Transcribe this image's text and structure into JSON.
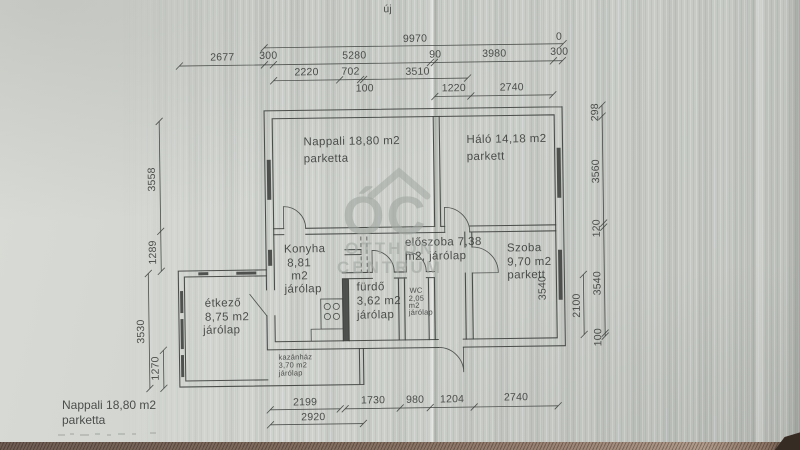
{
  "photo": {
    "top_annotation": "új"
  },
  "colors": {
    "paper": "#cdd0cb",
    "ink": "#3c3f3c",
    "watermark": "#a3a8a3",
    "fabric": "#7b675a"
  },
  "watermark": {
    "initials": "ÓC",
    "line1": "OTTHON",
    "line2": "CENTRUM"
  },
  "rooms": {
    "nappali": {
      "line1": "Nappali 18,80 m2",
      "line2": "parketta"
    },
    "halo": {
      "line1": "Háló 14,18 m2",
      "line2": "parkett"
    },
    "konyha": {
      "line1": "Konyha",
      "line2": "8,81",
      "line3": "m2",
      "line4": "járólap"
    },
    "etkezo": {
      "line1": "étkező",
      "line2": "8,75 m2",
      "line3": "járólap"
    },
    "eloszoba": {
      "line1": "előszoba 7,38",
      "line2": "m2, járólap"
    },
    "szoba": {
      "line1": "Szoba",
      "line2": "9,70 m2",
      "line3": "parkett",
      "inner_dim": "3540"
    },
    "furdo": {
      "line1": "fürdő",
      "line2": "3,62 m2",
      "line3": "járólap"
    },
    "wc": {
      "line1": "WC",
      "line2": "2,05",
      "line3": "m2",
      "line4": "járólap"
    },
    "kazanhaz": {
      "line1": "kazánház",
      "line2": "3,70 m2",
      "line3": "járólap"
    }
  },
  "dimensions": {
    "top_total": "9970",
    "top_zero": "0",
    "row2": [
      "2677",
      "300",
      "5280",
      "90",
      "3980",
      "300"
    ],
    "row3": [
      "2220",
      "702",
      "3510"
    ],
    "row3b": "100",
    "row4": [
      "1220",
      "2740"
    ],
    "left": [
      "3558",
      "1289",
      "3530",
      "1270"
    ],
    "right": [
      "298",
      "3560",
      "120",
      "3540",
      "100"
    ],
    "right_inner": "2100",
    "bottom": [
      "2199",
      "1730",
      "980",
      "1204",
      "2740"
    ],
    "bottom2": "2920"
  },
  "footer": {
    "line1": "Nappali 18,80 m2",
    "line2": "parketta"
  }
}
